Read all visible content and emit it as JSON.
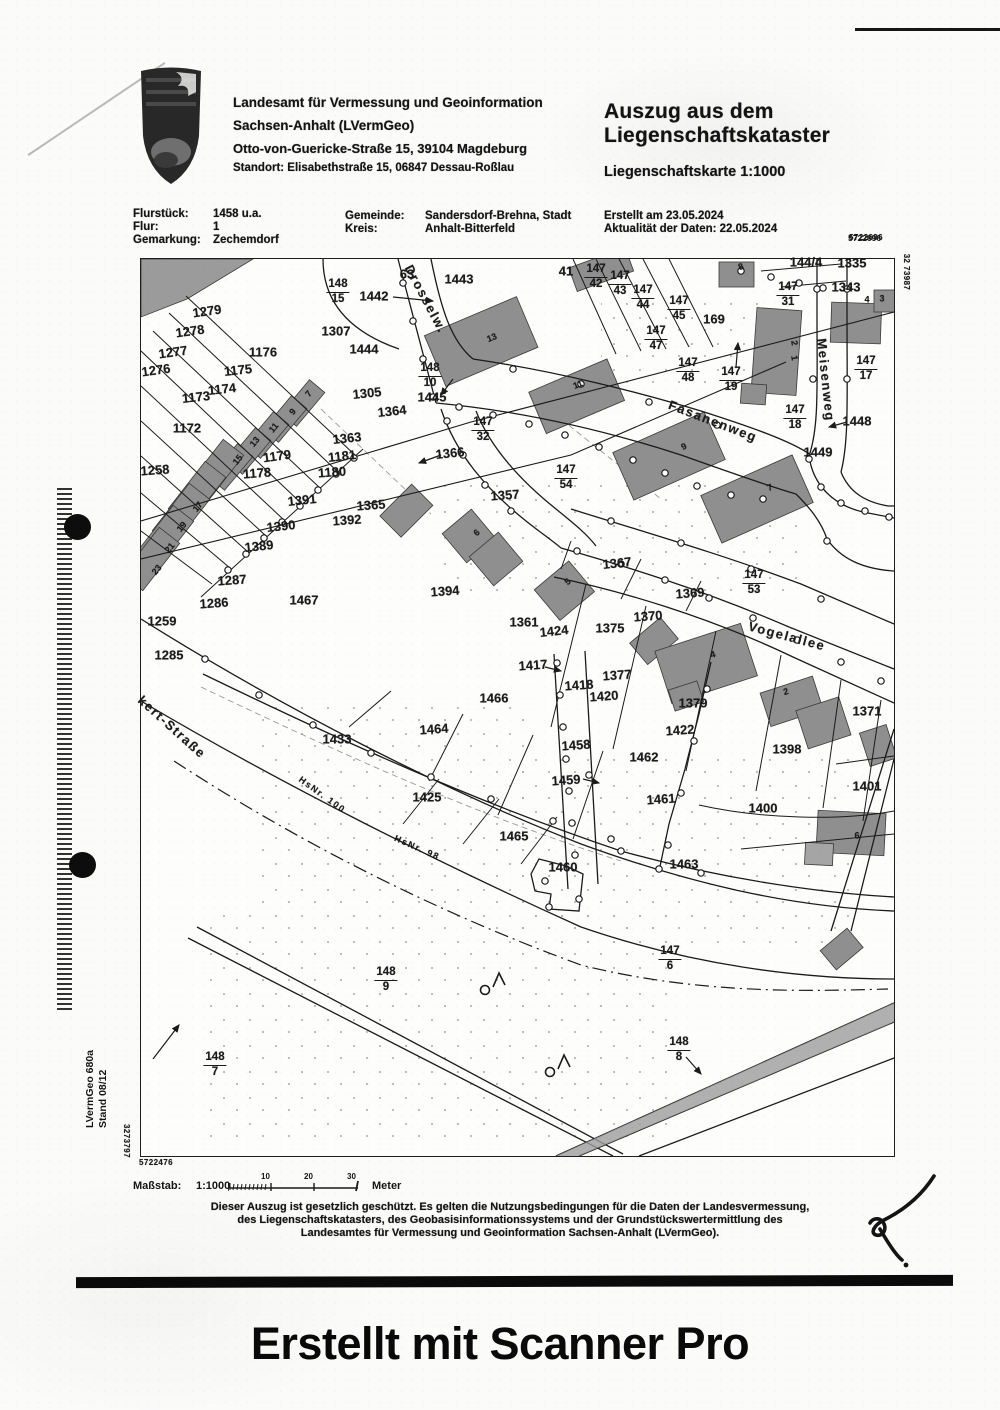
{
  "header": {
    "agency_line1": "Landesamt für Vermessung und Geoinformation",
    "agency_line2": "Sachsen-Anhalt (LVermGeo)",
    "agency_line3": "Otto-von-Guericke-Straße 15, 39104 Magdeburg",
    "agency_line4": "Standort: Elisabethstraße 15, 06847 Dessau-Roßlau",
    "title_line1": "Auszug aus dem",
    "title_line2": "Liegenschaftskataster",
    "subtitle": "Liegenschaftskarte 1:1000",
    "created": "Erstellt am 23.05.2024",
    "data_currency": "Aktualität der Daten: 22.05.2024",
    "doc_number_top": "5722696"
  },
  "meta": {
    "flurstueck_label": "Flurstück:",
    "flurstueck_value": "1458 u.a.",
    "flur_label": "Flur:",
    "flur_value": "1",
    "gemarkung_label": "Gemarkung:",
    "gemarkung_value": "Zechemdorf",
    "gemeinde_label": "Gemeinde:",
    "gemeinde_value": "Sandersdorf-Brehna, Stadt",
    "kreis_label": "Kreis:",
    "kreis_value": "Anhalt-Bitterfeld"
  },
  "map": {
    "parcel_labels": [
      {
        "t": "1442",
        "x": 374,
        "y": 296
      },
      {
        "t": "63",
        "x": 407,
        "y": 274
      },
      {
        "t": "1443",
        "x": 459,
        "y": 279
      },
      {
        "t": "1279",
        "x": 207,
        "y": 311,
        "r": -8
      },
      {
        "t": "1278",
        "x": 190,
        "y": 331,
        "r": -8
      },
      {
        "t": "1277",
        "x": 173,
        "y": 352,
        "r": -8
      },
      {
        "t": "1276",
        "x": 156,
        "y": 370,
        "r": -8
      },
      {
        "t": "1176",
        "x": 263,
        "y": 352
      },
      {
        "t": "1175",
        "x": 238,
        "y": 370,
        "r": -6
      },
      {
        "t": "1174",
        "x": 222,
        "y": 389,
        "r": -6
      },
      {
        "t": "1173",
        "x": 196,
        "y": 397,
        "r": -6
      },
      {
        "t": "1172",
        "x": 187,
        "y": 428
      },
      {
        "t": "1307",
        "x": 336,
        "y": 331
      },
      {
        "t": "1444",
        "x": 364,
        "y": 349
      },
      {
        "t": "1305",
        "x": 367,
        "y": 393,
        "r": -6
      },
      {
        "t": "1445",
        "x": 432,
        "y": 397
      },
      {
        "t": "1364",
        "x": 392,
        "y": 411,
        "r": -6
      },
      {
        "t": "1363",
        "x": 347,
        "y": 438,
        "r": -6
      },
      {
        "t": "1366",
        "x": 450,
        "y": 453,
        "r": -6
      },
      {
        "t": "1181",
        "x": 342,
        "y": 456,
        "r": -6
      },
      {
        "t": "1180",
        "x": 332,
        "y": 472,
        "r": -4
      },
      {
        "t": "1179",
        "x": 277,
        "y": 456,
        "r": -8
      },
      {
        "t": "1178",
        "x": 257,
        "y": 473,
        "r": -4
      },
      {
        "t": "1258",
        "x": 155,
        "y": 470,
        "r": -4
      },
      {
        "t": "41",
        "x": 566,
        "y": 271
      },
      {
        "t": "169",
        "x": 714,
        "y": 319
      },
      {
        "t": "144/4",
        "x": 806,
        "y": 262
      },
      {
        "t": "1335",
        "x": 852,
        "y": 263
      },
      {
        "t": "1343",
        "x": 846,
        "y": 287
      },
      {
        "t": "1448",
        "x": 857,
        "y": 421
      },
      {
        "t": "1449",
        "x": 818,
        "y": 452
      },
      {
        "t": "1391",
        "x": 302,
        "y": 500,
        "r": -6
      },
      {
        "t": "1392",
        "x": 347,
        "y": 520,
        "r": -4
      },
      {
        "t": "1390",
        "x": 281,
        "y": 526,
        "r": -6
      },
      {
        "t": "1389",
        "x": 259,
        "y": 546,
        "r": -6
      },
      {
        "t": "1365",
        "x": 371,
        "y": 505,
        "r": -4
      },
      {
        "t": "1357",
        "x": 505,
        "y": 495,
        "r": -4
      },
      {
        "t": "1287",
        "x": 232,
        "y": 580,
        "r": -4
      },
      {
        "t": "1286",
        "x": 214,
        "y": 603,
        "r": -4
      },
      {
        "t": "1259",
        "x": 162,
        "y": 621
      },
      {
        "t": "1285",
        "x": 169,
        "y": 655
      },
      {
        "t": "1467",
        "x": 304,
        "y": 600
      },
      {
        "t": "1394",
        "x": 445,
        "y": 591,
        "r": -4
      },
      {
        "t": "1361",
        "x": 524,
        "y": 622
      },
      {
        "t": "1367",
        "x": 617,
        "y": 563,
        "r": -6
      },
      {
        "t": "1369",
        "x": 690,
        "y": 593,
        "r": -4
      },
      {
        "t": "1370",
        "x": 648,
        "y": 616,
        "r": -4
      },
      {
        "t": "1424",
        "x": 554,
        "y": 631,
        "r": -6
      },
      {
        "t": "1375",
        "x": 610,
        "y": 628
      },
      {
        "t": "1417",
        "x": 533,
        "y": 665,
        "r": -4
      },
      {
        "t": "1418",
        "x": 579,
        "y": 685,
        "r": -4
      },
      {
        "t": "1420",
        "x": 604,
        "y": 696,
        "r": -4
      },
      {
        "t": "1377",
        "x": 617,
        "y": 675,
        "r": -4
      },
      {
        "t": "1379",
        "x": 693,
        "y": 703
      },
      {
        "t": "1422",
        "x": 680,
        "y": 730,
        "r": -4
      },
      {
        "t": "1458",
        "x": 576,
        "y": 745,
        "r": -4
      },
      {
        "t": "1462",
        "x": 644,
        "y": 757
      },
      {
        "t": "1459",
        "x": 566,
        "y": 780,
        "r": -4
      },
      {
        "t": "1398",
        "x": 787,
        "y": 749
      },
      {
        "t": "1371",
        "x": 867,
        "y": 711
      },
      {
        "t": "1401",
        "x": 867,
        "y": 786
      },
      {
        "t": "1433",
        "x": 337,
        "y": 739
      },
      {
        "t": "1466",
        "x": 494,
        "y": 698
      },
      {
        "t": "1464",
        "x": 434,
        "y": 729,
        "r": -4
      },
      {
        "t": "1425",
        "x": 427,
        "y": 797
      },
      {
        "t": "1461",
        "x": 661,
        "y": 799,
        "r": -4
      },
      {
        "t": "1400",
        "x": 763,
        "y": 808
      },
      {
        "t": "1465",
        "x": 514,
        "y": 836
      },
      {
        "t": "1460",
        "x": 563,
        "y": 867
      },
      {
        "t": "1463",
        "x": 684,
        "y": 864
      }
    ],
    "fraction_labels": [
      {
        "n": "148",
        "d": "15",
        "x": 338,
        "y": 292
      },
      {
        "n": "148",
        "d": "10",
        "x": 430,
        "y": 376
      },
      {
        "n": "147",
        "d": "32",
        "x": 483,
        "y": 430
      },
      {
        "n": "147",
        "d": "42",
        "x": 596,
        "y": 277
      },
      {
        "n": "147",
        "d": "43",
        "x": 620,
        "y": 284
      },
      {
        "n": "147",
        "d": "44",
        "x": 643,
        "y": 298
      },
      {
        "n": "147",
        "d": "45",
        "x": 679,
        "y": 309
      },
      {
        "n": "147",
        "d": "47",
        "x": 656,
        "y": 339
      },
      {
        "n": "147",
        "d": "48",
        "x": 688,
        "y": 371
      },
      {
        "n": "147",
        "d": "19",
        "x": 731,
        "y": 380
      },
      {
        "n": "147",
        "d": "31",
        "x": 788,
        "y": 295
      },
      {
        "n": "147",
        "d": "17",
        "x": 866,
        "y": 369
      },
      {
        "n": "147",
        "d": "18",
        "x": 795,
        "y": 418
      },
      {
        "n": "147",
        "d": "54",
        "x": 566,
        "y": 478
      },
      {
        "n": "147",
        "d": "53",
        "x": 754,
        "y": 583
      },
      {
        "n": "147",
        "d": "6",
        "x": 670,
        "y": 959
      },
      {
        "n": "148",
        "d": "9",
        "x": 386,
        "y": 980
      },
      {
        "n": "148",
        "d": "7",
        "x": 215,
        "y": 1065
      },
      {
        "n": "148",
        "d": "8",
        "x": 679,
        "y": 1050
      }
    ],
    "street_labels": [
      {
        "t": "Drosselw.",
        "x": 426,
        "y": 299,
        "r": 62
      },
      {
        "t": "Fasanenweg",
        "x": 713,
        "y": 421,
        "r": 21
      },
      {
        "t": "Vogelallee",
        "x": 787,
        "y": 636,
        "r": 15
      },
      {
        "t": "Meisenweg",
        "x": 826,
        "y": 380,
        "r": 84
      },
      {
        "t": "kert-Straße",
        "x": 172,
        "y": 727,
        "r": 42
      },
      {
        "t": "HsNr. 100",
        "x": 322,
        "y": 795,
        "r": 36,
        "s": 9
      },
      {
        "t": "HsNr. 98",
        "x": 417,
        "y": 848,
        "r": 24,
        "s": 9
      }
    ],
    "house_numbers": [
      {
        "t": "7",
        "x": 309,
        "y": 394,
        "r": -50
      },
      {
        "t": "9",
        "x": 293,
        "y": 412,
        "r": -50
      },
      {
        "t": "11",
        "x": 274,
        "y": 428,
        "r": -50
      },
      {
        "t": "13",
        "x": 255,
        "y": 442,
        "r": -50
      },
      {
        "t": "15",
        "x": 238,
        "y": 460,
        "r": -50
      },
      {
        "t": "17",
        "x": 198,
        "y": 507,
        "r": -50
      },
      {
        "t": "19",
        "x": 182,
        "y": 527,
        "r": -50
      },
      {
        "t": "21",
        "x": 170,
        "y": 548,
        "r": -50
      },
      {
        "t": "23",
        "x": 157,
        "y": 570,
        "r": -50
      },
      {
        "t": "13",
        "x": 492,
        "y": 338,
        "r": -22
      },
      {
        "t": "11",
        "x": 578,
        "y": 385,
        "r": -22
      },
      {
        "t": "9",
        "x": 684,
        "y": 447,
        "r": -24
      },
      {
        "t": "7",
        "x": 770,
        "y": 488,
        "r": -24
      },
      {
        "t": "8",
        "x": 741,
        "y": 267,
        "r": -20
      },
      {
        "t": "2",
        "x": 794,
        "y": 343,
        "r": 80
      },
      {
        "t": "1",
        "x": 794,
        "y": 358,
        "r": 80
      },
      {
        "t": "4",
        "x": 867,
        "y": 300
      },
      {
        "t": "3",
        "x": 882,
        "y": 299
      },
      {
        "t": "5",
        "x": 568,
        "y": 582,
        "r": -40
      },
      {
        "t": "6",
        "x": 477,
        "y": 533,
        "r": -40
      },
      {
        "t": "4",
        "x": 713,
        "y": 655,
        "r": -16
      },
      {
        "t": "2",
        "x": 786,
        "y": 692,
        "r": -16
      },
      {
        "t": "6",
        "x": 857,
        "y": 836
      }
    ],
    "grid_coords": [
      {
        "t": "5722696",
        "x": 866,
        "y": 238
      },
      {
        "t": "32 73987",
        "x": 906,
        "y": 272,
        "r": 90
      },
      {
        "t": "5722476",
        "x": 156,
        "y": 1163
      },
      {
        "t": "3273797",
        "x": 126,
        "y": 1141,
        "r": 90
      }
    ]
  },
  "footer": {
    "massstab_label": "Maßstab:",
    "massstab_value": "1:1000",
    "scale_ticks": [
      "10",
      "20",
      "30"
    ],
    "meter_label": "Meter",
    "legal_line1": "Dieser Auszug ist gesetzlich geschützt. Es gelten die Nutzungsbedingungen für die Daten der Landesvermessung,",
    "legal_line2": "des Liegenschaftskatasters, des Geobasisinformationssystems und der Grundstückswertermittlung des",
    "legal_line3": "Landesamtes für Vermessung und Geoinformation Sachsen-Anhalt (LVermGeo).",
    "side_code": "LVermGeo 680a",
    "side_stand": "Stand 08/12"
  },
  "caption": {
    "text": "Erstellt mit Scanner Pro"
  },
  "colors": {
    "ink": "#1b1b1b",
    "building_fill": "#8f8f8f",
    "paper": "#fbfbfa"
  }
}
